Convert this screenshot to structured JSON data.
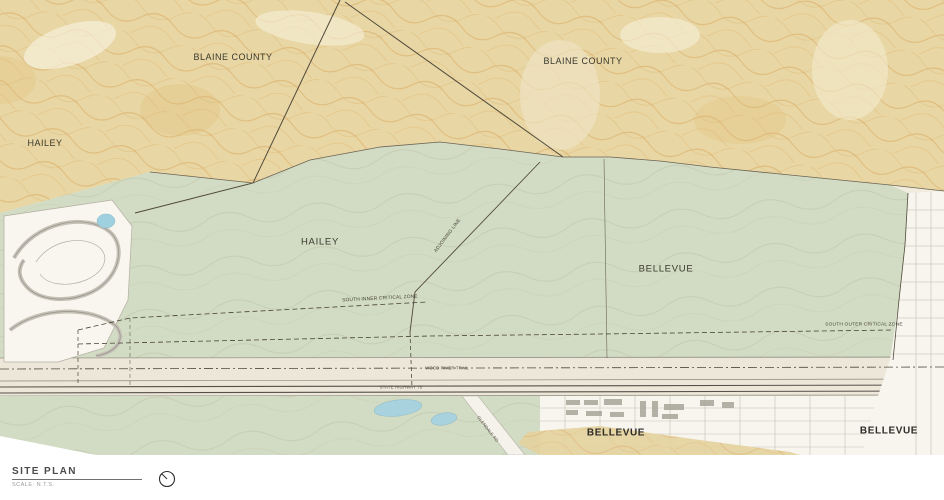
{
  "title_block": {
    "title": "SITE PLAN",
    "scale_note": "SCALE: N.T.S."
  },
  "map": {
    "region_labels": {
      "blaine_county_left": "BLAINE COUNTY",
      "blaine_county_right": "BLAINE COUNTY",
      "hailey_city": "HAILEY",
      "hailey_parcel": "HAILEY",
      "bellevue_parcel": "BELLEVUE",
      "bellevue_town_center": "BELLEVUE",
      "bellevue_town_east": "BELLEVUE"
    },
    "line_labels": {
      "adjoining_line": "ADJOINING LINE",
      "south_inner_critical_zone": "SOUTH INNER CRITICAL ZONE",
      "south_outer_critical_zone": "SOUTH OUTER CRITICAL ZONE",
      "wood_river_trail": "WOOD RIVER TRAIL",
      "state_highway": "STATE HIGHWAY 75",
      "glendale_road": "GLENDALE RD"
    },
    "colors": {
      "hillside_tan": "#e8d7a4",
      "contour_orange": "#d9a45c",
      "valley_green": "#d2dbc3",
      "water_blue": "#a9d2df",
      "boundary_line": "#50493a",
      "urban_white": "#f7f5ee"
    },
    "icons": {
      "north_arrow": "north-arrow-circle"
    }
  }
}
